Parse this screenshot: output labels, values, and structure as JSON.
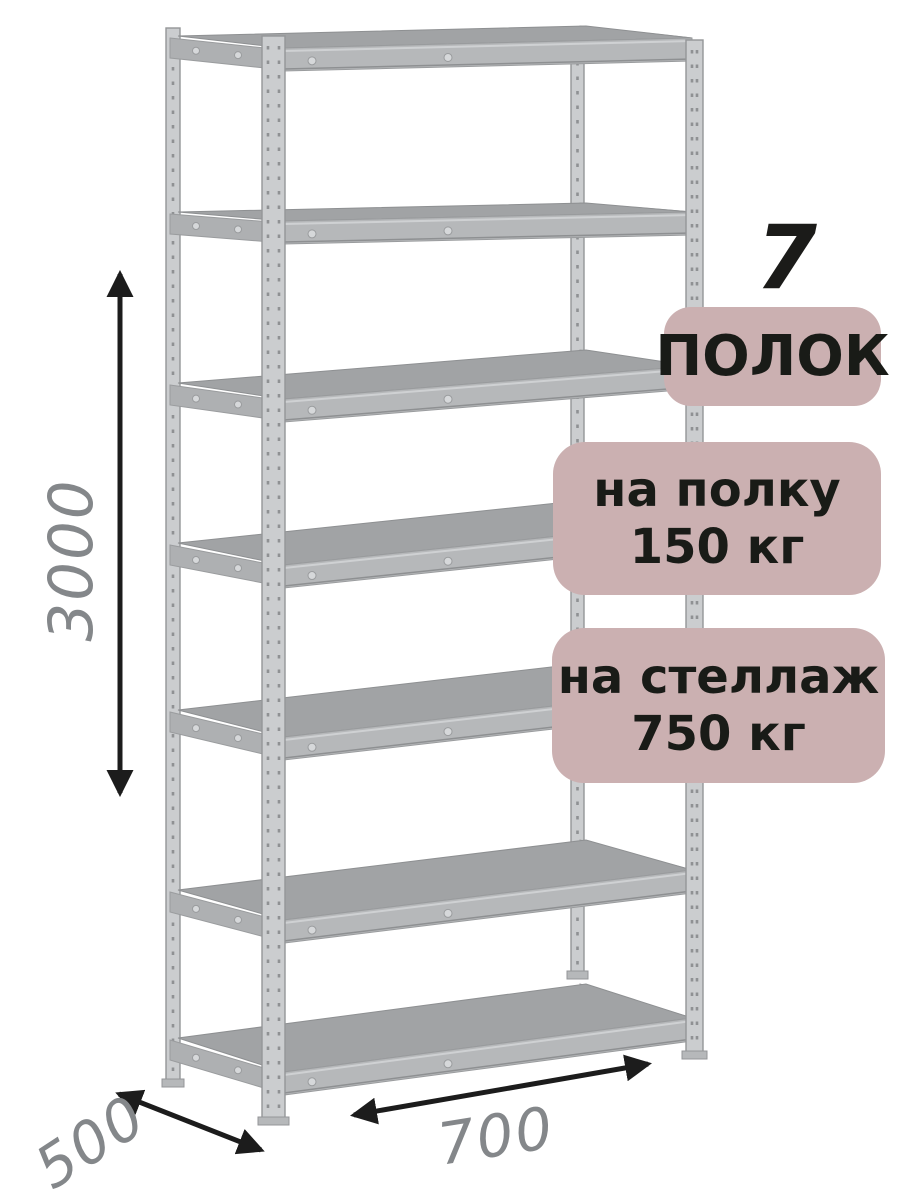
{
  "product": {
    "shelf_count": "7",
    "shelf_count_label": "ПОЛОК",
    "shelf_load_badge": {
      "line1": "на полку",
      "line2": "150 кг"
    },
    "rack_load_badge": {
      "line1": "на стеллаж",
      "line2": "750 кг"
    },
    "dimensions": {
      "height": "3000",
      "depth": "500",
      "width": "700"
    }
  },
  "colors": {
    "background": "#ffffff",
    "badge_bg": "#cbb0b1",
    "badge_text": "#191b17",
    "count_text": "#1b1b19",
    "dimension_text": "#84878a",
    "arrow": "#1c1c1c",
    "metal_post": "#cbcdcf",
    "metal_post_edge": "#94969",
    "metal_post_edge_full": "#949698",
    "metal_beam": "#b6b8ba",
    "metal_beam_edge": "#9a9c9e",
    "metal_deck": "#a1a3a5",
    "metal_deck_edge": "#8e9092",
    "metal_side": "#aeb0b2",
    "screw_fill": "#d6d8da",
    "hole_color": "#8f9193"
  }
}
